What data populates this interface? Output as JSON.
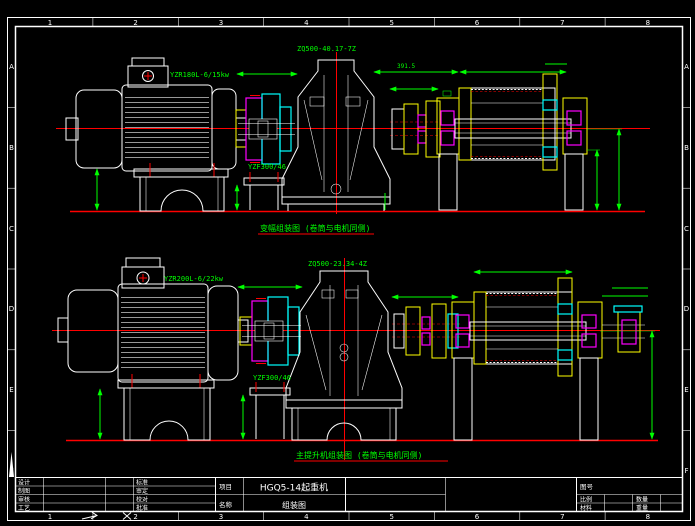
{
  "colors": {
    "white": "#ffffff",
    "green": "#00ff00",
    "red": "#ff0000",
    "magenta": "#ff00ff",
    "cyan": "#00ffff",
    "yellow": "#ffff00",
    "background": "#000000"
  },
  "border": {
    "columns": [
      "1",
      "2",
      "3",
      "4",
      "5",
      "6",
      "7",
      "8"
    ],
    "rows": [
      "A",
      "B",
      "C",
      "D",
      "E",
      "F"
    ]
  },
  "views": {
    "top": {
      "caption": "变幅组装图 (卷筒与电机同侧)",
      "motor_label": "YZR180L-6/15kw",
      "coupling_label": "YZF300/46",
      "reducer_label": "ZQ500-40.17-7Z",
      "dims": {
        "drum_left": "391.5"
      }
    },
    "bottom": {
      "caption": "主提升机组装图 (卷筒与电机同侧)",
      "motor_label": "YZR200L-6/22kw",
      "coupling_label": "YZF300/46",
      "reducer_label": "ZQ500-23.34-4Z"
    }
  },
  "title_block": {
    "rows": [
      {
        "c1": "设计",
        "c2": "标准"
      },
      {
        "c1": "制图",
        "c2": "审定"
      },
      {
        "c1": "审核",
        "c2": "校对"
      },
      {
        "c1": "工艺",
        "c2": "批准"
      }
    ],
    "project_label": "项目",
    "project_value": "HGQ5-14起重机",
    "name_label": "名称",
    "name_value": "组装图",
    "drawing_no_label": "图号",
    "scale_label": "比例",
    "quantity_label": "数量",
    "material_label": "材料",
    "weight_label": "重量"
  }
}
